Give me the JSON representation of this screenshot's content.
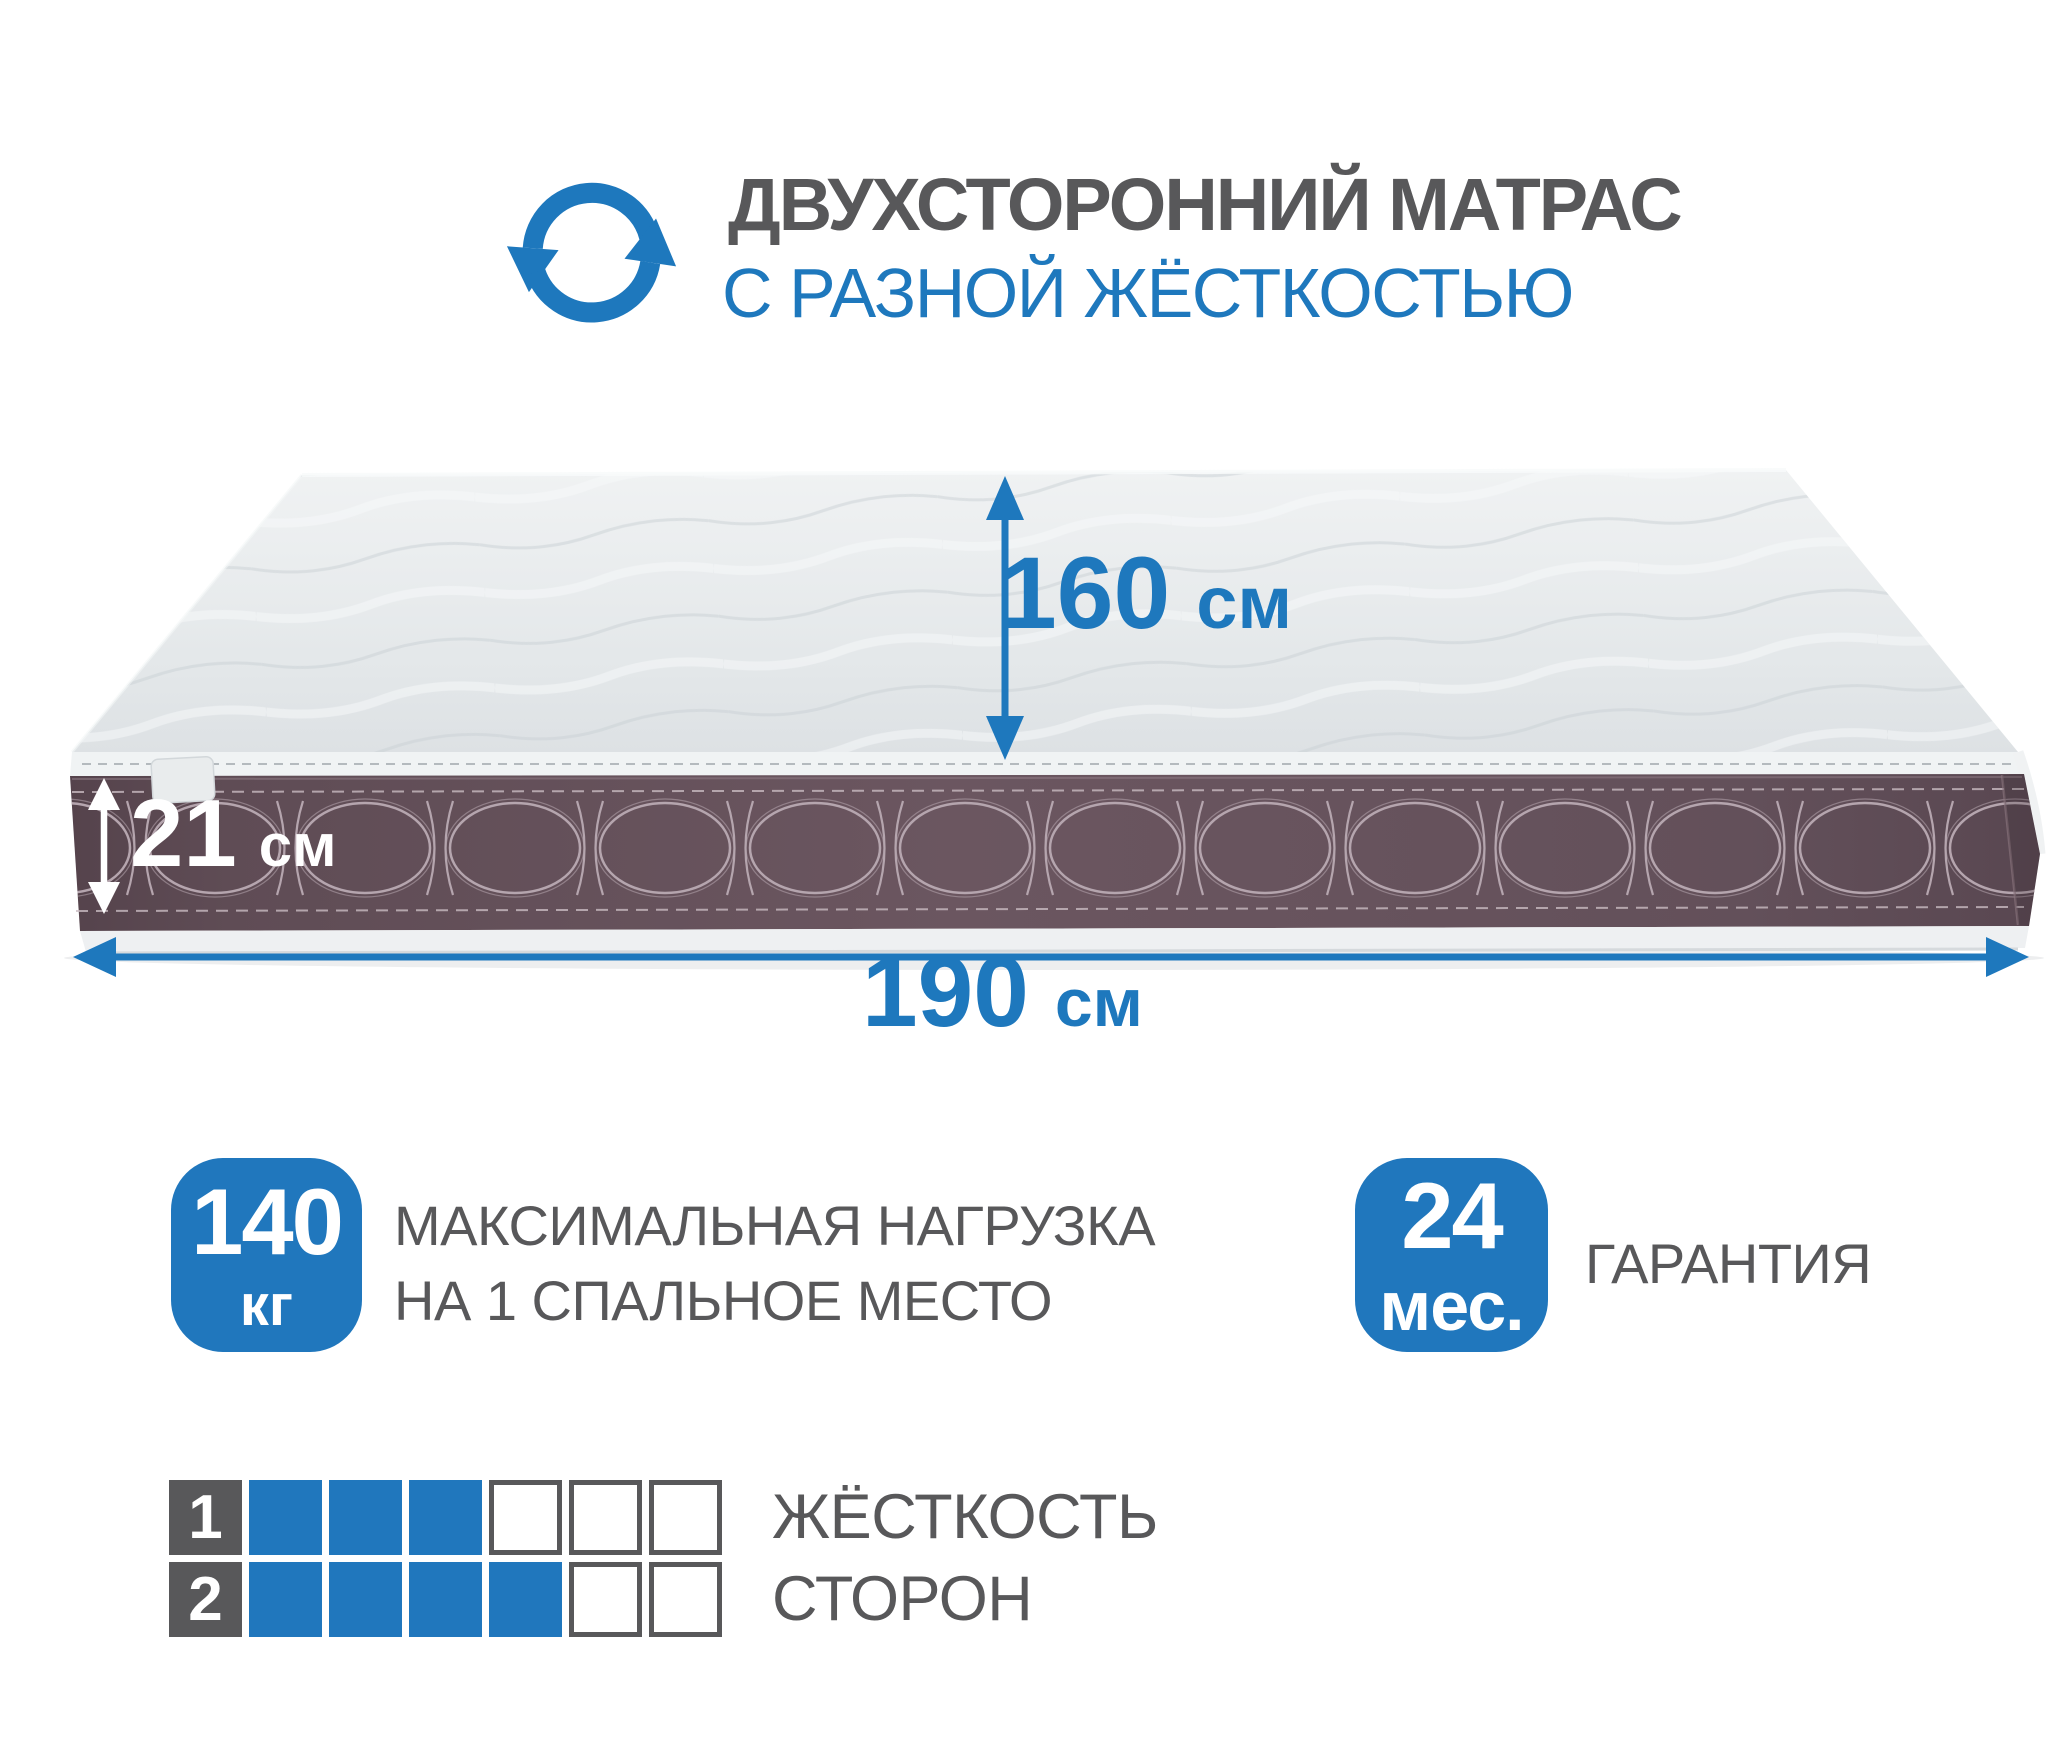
{
  "colors": {
    "accent": "#1e78bd",
    "badge": "#2077bd",
    "text_gray": "#58585a",
    "band": "#65515a",
    "top_surface": "#e3e6e8"
  },
  "header": {
    "icon": "rotate-arrows-icon",
    "title": "ДВУХСТОРОННИЙ МАТРАС",
    "subtitle": "С РАЗНОЙ ЖЁСТКОСТЬЮ"
  },
  "dimensions": {
    "depth": {
      "value": "160",
      "unit": "см"
    },
    "height": {
      "value": "21",
      "unit": "см"
    },
    "width": {
      "value": "190",
      "unit": "см"
    }
  },
  "features": {
    "max_load": {
      "value": "140",
      "unit": "кг",
      "label_line1": "МАКСИМАЛЬНАЯ НАГРУЗКА",
      "label_line2": "НА 1 СПАЛЬНОЕ МЕСТО"
    },
    "warranty": {
      "value": "24",
      "unit": "мес.",
      "label": "ГАРАНТИЯ"
    }
  },
  "firmness": {
    "label_line1": "ЖЁСТКОСТЬ",
    "label_line2": "СТОРОН",
    "scale_max": 6,
    "sides": [
      {
        "side": "1",
        "value": 3
      },
      {
        "side": "2",
        "value": 4
      }
    ]
  }
}
